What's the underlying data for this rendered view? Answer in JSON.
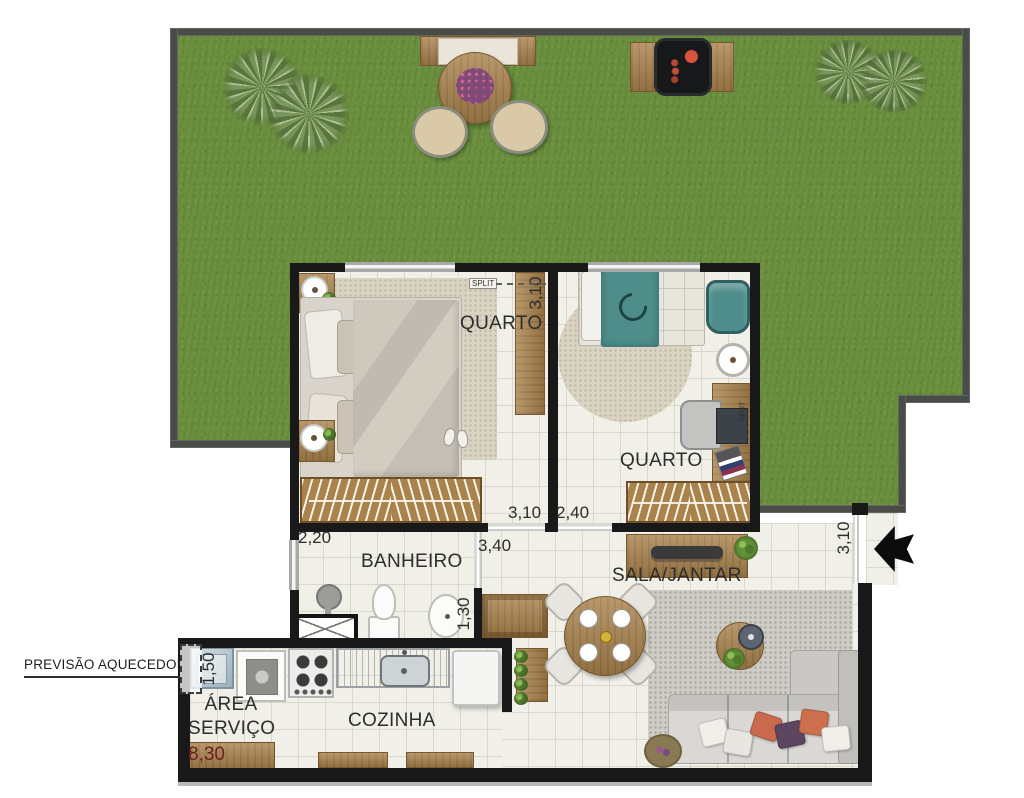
{
  "rooms": {
    "quarto1_label": "QUARTO",
    "quarto2_label": "QUARTO",
    "banheiro_label": "BANHEIRO",
    "sala_label": "SALA/JANTAR",
    "cozinha_label": "COZINHA",
    "area_servico_line1": "ÁREA",
    "area_servico_line2": "SERVIÇO"
  },
  "dimensions": {
    "quarto1_depth": "3,10",
    "quarto1_width": "3,10",
    "quarto2_width": "2,40",
    "banheiro_width": "2,20",
    "hall_span": "3,40",
    "banheiro_depth": "1,30",
    "aquecedor_width": "1,50",
    "total_width": "8,30",
    "entry_depth": "3,10"
  },
  "annotations": {
    "previsao_aquecedor": "PREVISÃO AQUECEDOR",
    "split_quarto1": "SPLIT",
    "split_quarto2": "SPLIT"
  },
  "colors": {
    "grass": "#6a8f3e",
    "garden_wall": "#4a4c48",
    "interior_wall": "#191919",
    "floor": "#f0efe8",
    "wood": "#a9824c",
    "dim_text": "#2d2d2d",
    "total_width_text": "#6b1d1d",
    "accent_teal": "#4e8d8a",
    "accent_orange": "#c96a4c"
  }
}
